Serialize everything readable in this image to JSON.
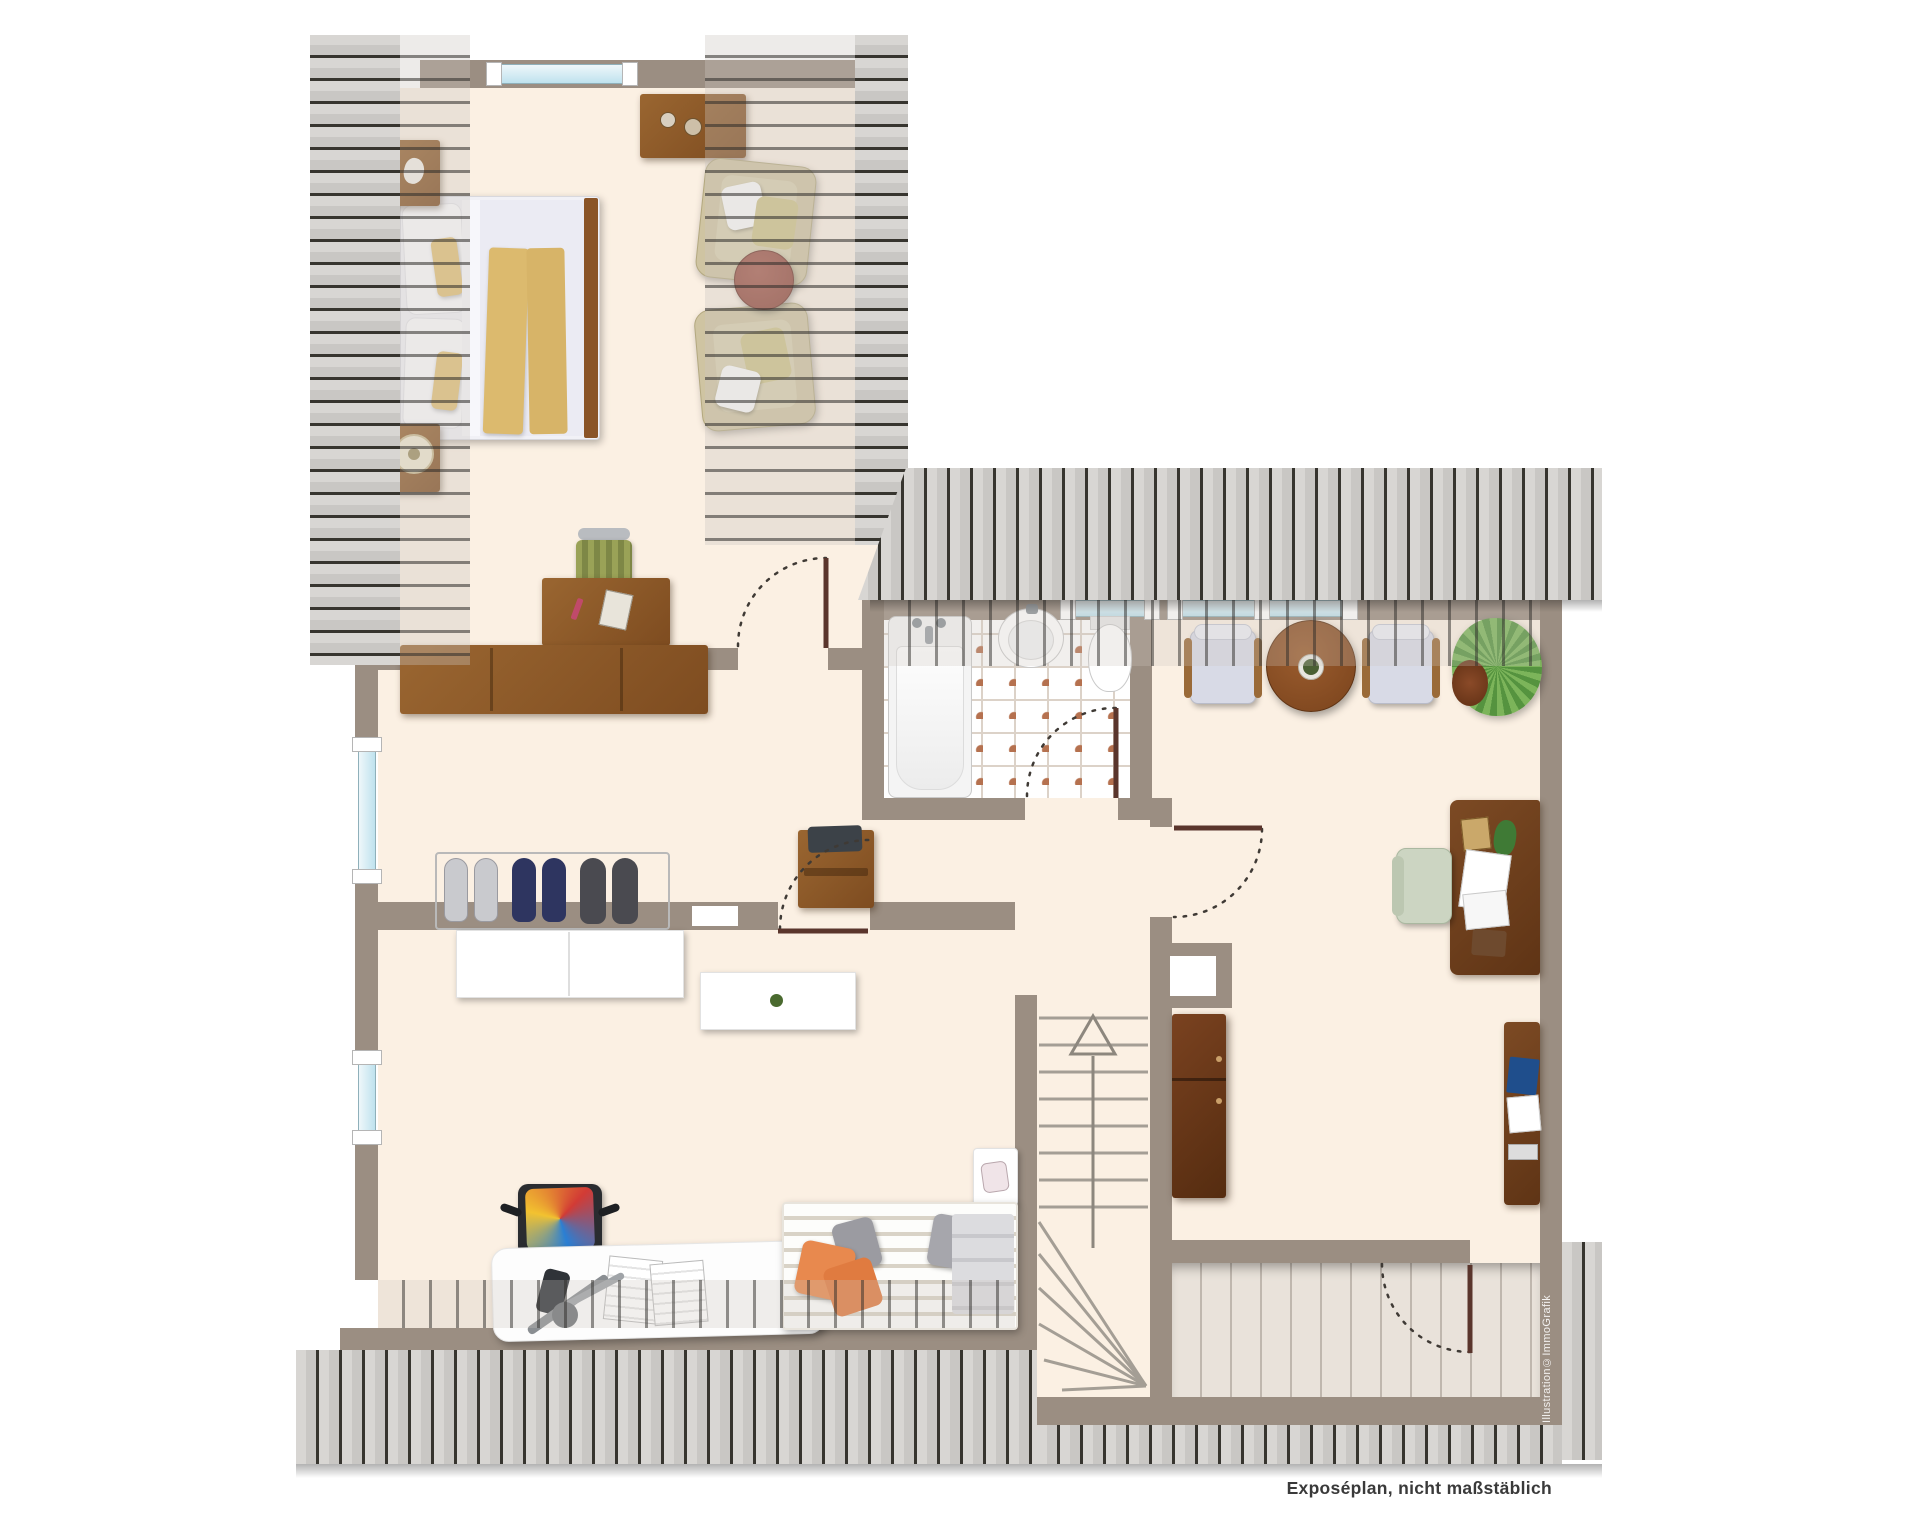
{
  "texts": {
    "footer_note": "Exposéplan, nicht maßstäblich",
    "watermark": "Illustration©ImmoGrafik"
  },
  "colors": {
    "wall": "#9b8e82",
    "floor": "#fbf0e3",
    "deck": "#e9e2da",
    "hatch_light": "#d8d6d3",
    "hatch_dark": "#37352f",
    "window_glass": "#cfe9f2",
    "tile_accent": "#b5714f",
    "wood": "#8f5a2b",
    "wood_dark": "#6f3f1e",
    "door_leaf": "#5a352c",
    "swing_arc": "#3f3a35",
    "accent_yellow": "#e0bd72",
    "accent_orange": "#e8894e",
    "accent_blue": "#1f4e8c",
    "accent_green": "#6f9d4a",
    "text": "#3a3a3a"
  },
  "rooms": [
    {
      "id": "bedroom-lounge"
    },
    {
      "id": "hallway"
    },
    {
      "id": "bathroom"
    },
    {
      "id": "study"
    },
    {
      "id": "childrens-room"
    },
    {
      "id": "staircase"
    },
    {
      "id": "roof-terrace"
    }
  ]
}
